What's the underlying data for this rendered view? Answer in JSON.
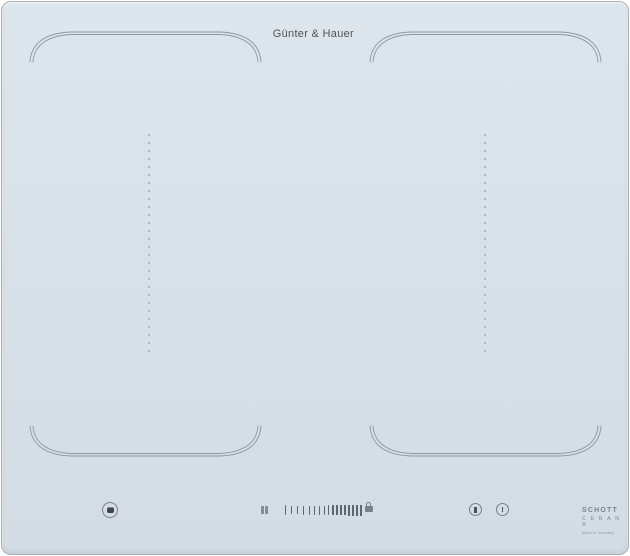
{
  "brand": {
    "label": "Günter & Hauer"
  },
  "theme": {
    "surface_top": "#dde6ed",
    "surface_bottom": "#d3dce4",
    "panel_border": "#a7b0b7",
    "zone_line": "#8d979f",
    "divider_dot": "#9fa9b1",
    "icon_color": "#79828a",
    "text_color": "#4e545a"
  },
  "zones": {
    "left_flex": {
      "name": "left flex cooking zone"
    },
    "right_flex": {
      "name": "right flex cooking zone"
    }
  },
  "controls": {
    "power_button": {
      "name": "power"
    },
    "bridge_button": {
      "name": "zone bridge"
    },
    "lock_button": {
      "name": "child lock"
    },
    "timer_button": {
      "name": "pause"
    },
    "clock_button": {
      "name": "timer"
    },
    "slider": {
      "bars": [
        {
          "h": 10,
          "w": 1,
          "g": 5
        },
        {
          "h": 8,
          "w": 1,
          "g": 5
        },
        {
          "h": 8,
          "w": 1,
          "g": 5
        },
        {
          "h": 9,
          "w": 1,
          "g": 5
        },
        {
          "h": 9,
          "w": 1,
          "g": 4
        },
        {
          "h": 9,
          "w": 1,
          "g": 4
        },
        {
          "h": 9,
          "w": 1,
          "g": 4
        },
        {
          "h": 9,
          "w": 1,
          "g": 3
        },
        {
          "h": 10,
          "w": 1,
          "g": 3
        },
        {
          "h": 10,
          "w": 2,
          "g": 2
        },
        {
          "h": 10,
          "w": 2,
          "g": 2
        },
        {
          "h": 10,
          "w": 2,
          "g": 2
        },
        {
          "h": 10,
          "w": 2,
          "g": 2
        },
        {
          "h": 11,
          "w": 2,
          "g": 2
        },
        {
          "h": 11,
          "w": 2,
          "g": 2
        },
        {
          "h": 11,
          "w": 2,
          "g": 2
        },
        {
          "h": 11,
          "w": 2,
          "g": 0
        }
      ]
    }
  },
  "badge": {
    "maker": "SCHOTT",
    "product": "C E R A N ®",
    "origin": "Made in Germany"
  }
}
